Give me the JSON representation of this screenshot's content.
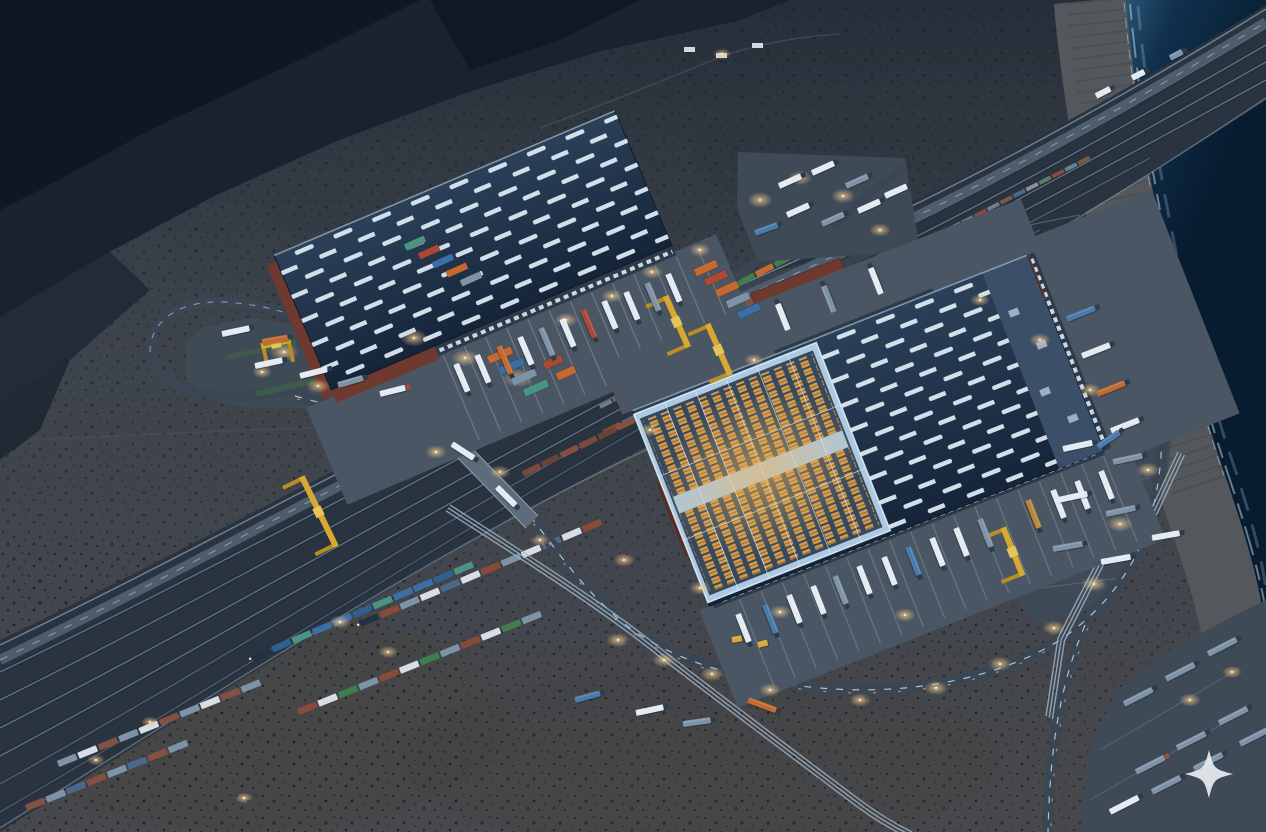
{
  "scene_label": "night aerial render of a desert rail-and-truck logistics hub on a coastline",
  "watermark": {
    "shape": "four-point-sparkle",
    "cx": 1209,
    "cy": 774,
    "r": 24,
    "color": "#e8edf1"
  },
  "palette": {
    "mtn": "#1a2230",
    "mtn_dark": "#0f1521",
    "mtn_lit": "#31404f",
    "desert_top": "#262e39",
    "desert_mid": "#3d434b",
    "desert_low": "#47484c",
    "sand": "#54575c",
    "shrub": "#161d26",
    "ocean_deep": "#081c30",
    "ocean_mid": "#10304d",
    "ocean_shore": "#2a5878",
    "foam": "#b7cedd",
    "corridor": "#2a3440",
    "bed": "#232d39",
    "track_line": "#607182",
    "edge_line": "#8296a6",
    "road": "#3a4653",
    "road_lit": "#4e5d6d",
    "bridge": "#5d6b7a",
    "marking": "#d6dfe8",
    "marking_red": "#c97e57",
    "pavement": "#3f4a57",
    "apron": "#4a5663",
    "lane": "#93a5b6",
    "roof": "#1c2d45",
    "roof_hi": "#2b4159",
    "skylight": "#dae8f1",
    "brick": "#6e392e",
    "brick_dk": "#572d24",
    "cutaway": "#b5d1e8",
    "cut_frame": "#ddeefb",
    "rack": "#d49a4b",
    "rack_gap": "#35495e",
    "crane": "#d7a832",
    "crane_dk": "#b98d26",
    "glow_core": "#ffe9c0",
    "glow_mid": "#f3d49b",
    "green": "#3f5c48",
    "pipe": "#9db4c6",
    "star": "#e8edf1",
    "truck_w": "#e3eaf1",
    "truck_s": "#7e93a8",
    "truck_b": "#4a7bad",
    "truck_r": "#a84a36",
    "truck_o": "#c26a31",
    "truck_t": "#4a9484",
    "truck_g": "#b8893c",
    "cab": "#2e3b4a",
    "loco": "#223243"
  },
  "scene": {
    "glows": [
      [
        284,
        352,
        15
      ],
      [
        318,
        386,
        12
      ],
      [
        262,
        372,
        10
      ],
      [
        414,
        338,
        14
      ],
      [
        465,
        358,
        14
      ],
      [
        518,
        378,
        15
      ],
      [
        566,
        320,
        12
      ],
      [
        612,
        296,
        11
      ],
      [
        652,
        272,
        11
      ],
      [
        700,
        250,
        11
      ],
      [
        760,
        200,
        13
      ],
      [
        800,
        178,
        12
      ],
      [
        843,
        196,
        12
      ],
      [
        880,
        230,
        11
      ],
      [
        436,
        452,
        11
      ],
      [
        500,
        472,
        11
      ],
      [
        340,
        622,
        11
      ],
      [
        388,
        652,
        10
      ],
      [
        618,
        640,
        12
      ],
      [
        664,
        660,
        12
      ],
      [
        712,
        674,
        12
      ],
      [
        770,
        690,
        11
      ],
      [
        860,
        700,
        11
      ],
      [
        936,
        688,
        12
      ],
      [
        1000,
        664,
        12
      ],
      [
        1054,
        628,
        12
      ],
      [
        1094,
        584,
        13
      ],
      [
        1120,
        524,
        13
      ],
      [
        1148,
        470,
        12
      ],
      [
        624,
        560,
        11
      ],
      [
        700,
        588,
        11
      ],
      [
        780,
        612,
        11
      ],
      [
        1190,
        700,
        11
      ],
      [
        1232,
        672,
        10
      ],
      [
        150,
        722,
        9
      ],
      [
        96,
        760,
        9
      ],
      [
        244,
        798,
        9
      ],
      [
        980,
        300,
        10
      ],
      [
        1040,
        340,
        11
      ],
      [
        1090,
        390,
        11
      ],
      [
        754,
        360,
        10
      ],
      [
        650,
        430,
        10
      ],
      [
        540,
        540,
        10
      ],
      [
        905,
        615,
        11
      ],
      [
        722,
        54,
        9
      ]
    ],
    "trains": [
      {
        "x": 600,
        "y": 407,
        "a": -27,
        "n": 38,
        "w": 13,
        "h": 4,
        "g": 1.5,
        "colors": [
          "#6e7e8c",
          "#7a5a45",
          "#49688a",
          "#8a8f97",
          "#5d7a6b",
          "#8a4a3a"
        ]
      },
      {
        "x": 585,
        "y": 442,
        "a": -26,
        "n": 12,
        "w": 19,
        "h": 6,
        "g": 2,
        "loco": 1,
        "colors": [
          "#d9dee4",
          "#8a4a3a",
          "#49688a",
          "#d9dee4",
          "#4a9484"
        ]
      },
      {
        "x": 523,
        "y": 474,
        "a": -26,
        "n": 13,
        "w": 19,
        "h": 6,
        "g": 2,
        "colors": [
          "#7a4a3a",
          "#6a4438",
          "#845043"
        ]
      },
      {
        "x": 528,
        "y": 392,
        "a": -26,
        "n": 10,
        "w": 19,
        "h": 6,
        "g": 2,
        "loco": 1,
        "colors": [
          "#2e5f92",
          "#3a6ea5",
          "#49688a"
        ]
      },
      {
        "x": 612,
        "y": 370,
        "a": -26,
        "n": 11,
        "w": 19,
        "h": 6,
        "g": 2,
        "colors": [
          "#7a4a3a",
          "#845043",
          "#6a4438"
        ]
      },
      {
        "x": 700,
        "y": 303,
        "a": -27,
        "n": 9,
        "w": 19,
        "h": 6,
        "g": 2,
        "colors": [
          "#3e7d4e",
          "#d9dee4",
          "#3e7d4e",
          "#c26a31"
        ]
      },
      {
        "x": 360,
        "y": 624,
        "a": -23,
        "n": 12,
        "w": 20,
        "h": 6.5,
        "g": 2,
        "loco": 1,
        "colors": [
          "#d9dee4",
          "#8a4a3a",
          "#7e93a8",
          "#d9dee4",
          "#49688a"
        ]
      },
      {
        "x": 252,
        "y": 658,
        "a": -23,
        "n": 11,
        "w": 20,
        "h": 6.5,
        "g": 2,
        "loco": 1,
        "colors": [
          "#3a6ea5",
          "#2e5f92",
          "#4a9484",
          "#3a6ea5"
        ]
      },
      {
        "x": 298,
        "y": 712,
        "a": -22,
        "n": 12,
        "w": 20,
        "h": 6.5,
        "g": 2,
        "colors": [
          "#8a4a3a",
          "#d9dee4",
          "#3e7d4e",
          "#7e93a8"
        ]
      },
      {
        "x": 58,
        "y": 764,
        "a": -22,
        "n": 10,
        "w": 20,
        "h": 6.5,
        "g": 2,
        "colors": [
          "#7e93a8",
          "#d9dee4",
          "#845043"
        ]
      },
      {
        "x": 26,
        "y": 808,
        "a": -22,
        "n": 8,
        "w": 20,
        "h": 6.5,
        "g": 2,
        "colors": [
          "#845043",
          "#7e93a8",
          "#49688a"
        ]
      }
    ],
    "trucks": [
      [
        456,
        364,
        67,
        30,
        "w"
      ],
      [
        477,
        355,
        67,
        30,
        "w"
      ],
      [
        499,
        346,
        67,
        30,
        "o"
      ],
      [
        520,
        337,
        67,
        30,
        "w"
      ],
      [
        541,
        328,
        67,
        30,
        "s"
      ],
      [
        562,
        319,
        67,
        30,
        "w"
      ],
      [
        583,
        310,
        67,
        30,
        "r"
      ],
      [
        604,
        301,
        67,
        30,
        "w"
      ],
      [
        626,
        292,
        67,
        30,
        "w"
      ],
      [
        647,
        283,
        67,
        30,
        "s"
      ],
      [
        668,
        274,
        67,
        30,
        "w"
      ],
      [
        738,
        614,
        68.5,
        30,
        "w"
      ],
      [
        765,
        605,
        68.5,
        30,
        "b"
      ],
      [
        789,
        595,
        68.5,
        30,
        "w"
      ],
      [
        813,
        586,
        68.5,
        30,
        "w"
      ],
      [
        835,
        576,
        68.5,
        30,
        "s"
      ],
      [
        859,
        566,
        68.5,
        30,
        "w"
      ],
      [
        884,
        557,
        68.5,
        30,
        "w"
      ],
      [
        908,
        547,
        68.5,
        30,
        "b"
      ],
      [
        932,
        538,
        68.5,
        30,
        "w"
      ],
      [
        956,
        528,
        68.5,
        30,
        "w"
      ],
      [
        980,
        519,
        68.5,
        30,
        "s"
      ],
      [
        1028,
        500,
        68.5,
        30,
        "g"
      ],
      [
        1053,
        490,
        68.5,
        30,
        "w"
      ],
      [
        1077,
        481,
        68.5,
        30,
        "w"
      ],
      [
        1101,
        471,
        68.5,
        30,
        "w"
      ],
      [
        1067,
        319,
        -21.5,
        30,
        "b"
      ],
      [
        1082,
        356,
        -21.5,
        30,
        "w"
      ],
      [
        1097,
        394,
        -21.5,
        30,
        "o"
      ],
      [
        1111,
        431,
        -21.5,
        30,
        "w"
      ],
      [
        788,
        330,
        248.5,
        28,
        "w"
      ],
      [
        834,
        312,
        248.5,
        28,
        "s"
      ],
      [
        881,
        294,
        248.5,
        28,
        "w"
      ],
      [
        222,
        334,
        -12,
        28,
        "w"
      ],
      [
        262,
        342,
        -10,
        26,
        "o"
      ],
      [
        255,
        366,
        -12,
        28,
        "w"
      ],
      [
        300,
        376,
        -14,
        28,
        "w"
      ],
      [
        338,
        385,
        -16,
        26,
        "s"
      ],
      [
        380,
        394,
        -14,
        26,
        "w",
        "#a84a36"
      ],
      [
        452,
        444,
        33,
        26,
        "w"
      ],
      [
        497,
        487,
        45,
        26,
        "w"
      ],
      [
        636,
        713,
        -12,
        28,
        "w"
      ],
      [
        683,
        724,
        -8,
        28,
        "s"
      ],
      [
        575,
        700,
        -15,
        26,
        "b"
      ],
      [
        748,
        700,
        20,
        30,
        "o"
      ],
      [
        758,
        645,
        -15,
        10,
        "y"
      ],
      [
        732,
        640,
        -10,
        10,
        "y"
      ],
      [
        1096,
        96,
        -27,
        16,
        "w"
      ],
      [
        1132,
        78,
        -27,
        14,
        "w"
      ],
      [
        1170,
        58,
        -27,
        14,
        "s"
      ],
      [
        1063,
        449,
        -12,
        30,
        "w"
      ],
      [
        1113,
        462,
        -12,
        30,
        "s"
      ],
      [
        1058,
        500,
        -12,
        30,
        "w"
      ],
      [
        1106,
        514,
        -12,
        30,
        "s"
      ],
      [
        1053,
        549,
        -10,
        30,
        "s"
      ],
      [
        1101,
        562,
        -10,
        30,
        "w"
      ],
      [
        1152,
        538,
        -10,
        28,
        "w"
      ],
      [
        1098,
        447,
        -35,
        26,
        "b"
      ],
      [
        1124,
        704,
        -27,
        32,
        "s"
      ],
      [
        1166,
        679,
        -27,
        32,
        "s"
      ],
      [
        1208,
        654,
        -27,
        32,
        "s"
      ],
      [
        1136,
        772,
        -27,
        32,
        "s",
        "#a84a36"
      ],
      [
        1177,
        748,
        -27,
        32,
        "s"
      ],
      [
        1219,
        723,
        -27,
        32,
        "s"
      ],
      [
        1110,
        812,
        -27,
        32,
        "w"
      ],
      [
        1152,
        792,
        -27,
        32,
        "s"
      ],
      [
        1194,
        769,
        -27,
        32,
        "s"
      ],
      [
        1240,
        744,
        -27,
        32,
        "s"
      ],
      [
        779,
        186,
        -24,
        24,
        "w"
      ],
      [
        812,
        173,
        -24,
        24,
        "w"
      ],
      [
        846,
        186,
        -24,
        24,
        "s"
      ],
      [
        787,
        215,
        -24,
        24,
        "w"
      ],
      [
        822,
        224,
        -24,
        24,
        "s"
      ],
      [
        858,
        211,
        -24,
        24,
        "w"
      ],
      [
        885,
        196,
        -24,
        24,
        "w"
      ],
      [
        755,
        233,
        -20,
        24,
        "b"
      ]
    ],
    "containers": [
      [
        500,
        355,
        -24,
        26,
        8,
        "#c26a31"
      ],
      [
        512,
        366,
        -24,
        26,
        8,
        "#3a6ea5"
      ],
      [
        524,
        377,
        -24,
        26,
        8,
        "#7e93a8"
      ],
      [
        536,
        388,
        -24,
        26,
        8,
        "#4a9484"
      ],
      [
        553,
        362,
        -24,
        20,
        8,
        "#a84a36"
      ],
      [
        566,
        373,
        -24,
        20,
        8,
        "#c26a31"
      ],
      [
        706,
        268,
        -24,
        24,
        8,
        "#c26a31"
      ],
      [
        716,
        278,
        -24,
        24,
        8,
        "#a84a36"
      ],
      [
        727,
        289,
        -24,
        24,
        8,
        "#c26a31"
      ],
      [
        738,
        300,
        -24,
        24,
        8,
        "#7e93a8"
      ],
      [
        749,
        311,
        -24,
        24,
        8,
        "#3a6ea5"
      ],
      [
        415,
        243,
        -24,
        22,
        7,
        "#4a9484"
      ],
      [
        429,
        252,
        -24,
        22,
        7,
        "#a84a36"
      ],
      [
        443,
        261,
        -24,
        22,
        7,
        "#3a6ea5"
      ],
      [
        457,
        270,
        -24,
        22,
        7,
        "#c26a31"
      ],
      [
        471,
        279,
        -24,
        22,
        7,
        "#7e93a8"
      ]
    ],
    "cranes": [
      [
        318,
        512,
        64,
        78
      ],
      [
        676,
        322,
        66,
        56
      ],
      [
        718,
        350,
        66,
        56
      ],
      [
        1012,
        552,
        68,
        52
      ],
      [
        276,
        344,
        -12,
        30
      ]
    ],
    "settlement": [
      [
        688,
        50
      ],
      [
        720,
        56
      ],
      [
        756,
        46
      ]
    ]
  }
}
